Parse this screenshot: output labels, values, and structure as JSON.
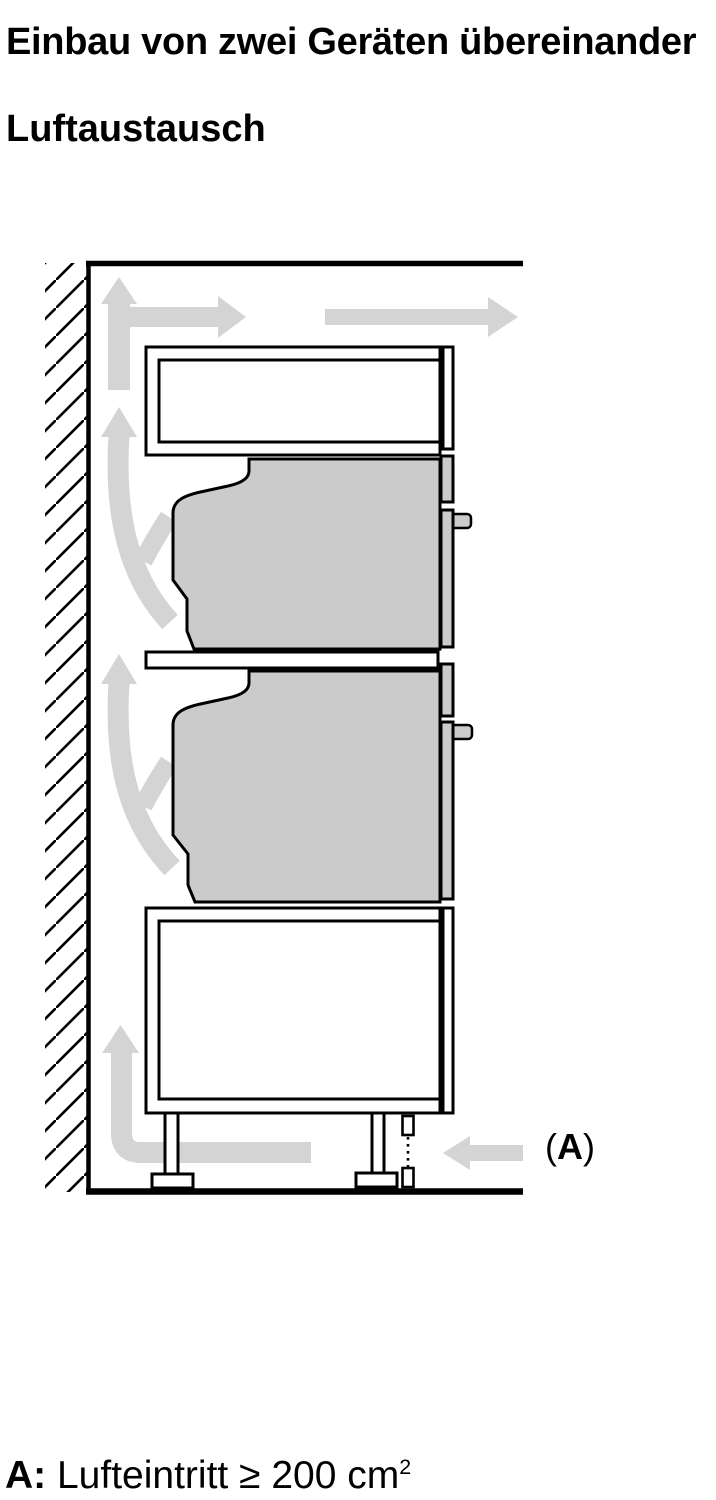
{
  "page": {
    "title": "Einbau von zwei Geräten übereinander",
    "subtitle": "Luftaustausch"
  },
  "diagram": {
    "air_inlet_label": {
      "open_paren": "(",
      "letter": "A",
      "close_paren": ")"
    }
  },
  "legend": {
    "prefix": "A:",
    "body": " Lufteintritt ≥ 200 cm",
    "superscript": "2"
  },
  "colors": {
    "arrow": "#d4d4d4",
    "appliance": "#cbcbcb",
    "line": "#000000",
    "bg": "#ffffff"
  }
}
